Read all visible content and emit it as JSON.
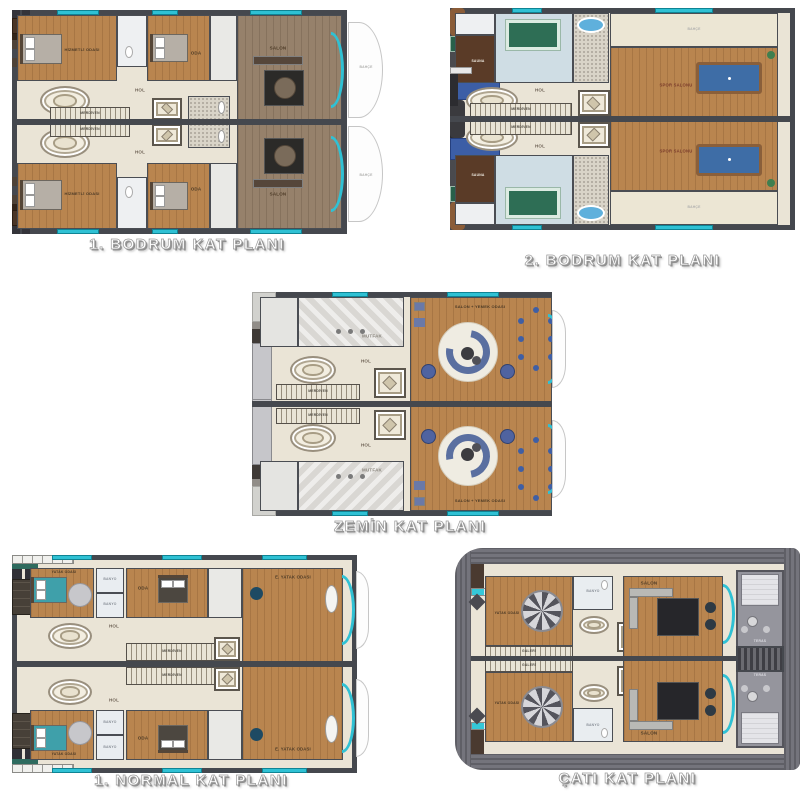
{
  "canvas": {
    "background": "#ffffff"
  },
  "colors": {
    "wall": "#45484e",
    "floor_cream": "#eae4d6",
    "wood": "#b9854f",
    "wood_taupe": "#96816b",
    "glass_teal": "#2fc1d4",
    "billiard_blue": "#3e6da6",
    "spa_green": "#2e6e55",
    "sauna_brown": "#5a3b27",
    "terrace_gray": "#95959d",
    "roof_gray": "#6a6a72",
    "sofa_blue": "#5a6fa0",
    "bed_teal": "#3fa0aa"
  },
  "plans": [
    {
      "title": "1. BODRUM KAT PLANI",
      "labels": {
        "service_room": "HİZMETLİ ODASI",
        "room": "ODA",
        "salon": "SALON",
        "hall": "HOL",
        "stairs": "MERDİVEN",
        "garden": "BAHÇE"
      }
    },
    {
      "title": "2. BODRUM KAT PLANI",
      "labels": {
        "sauna": "SAUNA",
        "gym": "SPOR SALONU",
        "hall": "HOL",
        "stairs": "MERDİVEN",
        "garden": "BAHÇE"
      }
    },
    {
      "title": "ZEMİN KAT PLANI",
      "labels": {
        "kitchen": "MUTFAK",
        "living": "SALON + YEMEK ODASI",
        "hall": "HOL",
        "stairs": "MERDİVEN"
      }
    },
    {
      "title": "1. NORMAL KAT PLANI",
      "labels": {
        "bedroom": "YATAK ODASI",
        "bath": "BANYO",
        "room": "ODA",
        "master": "E. YATAK ODASI",
        "hall": "HOL",
        "stairs": "MERDİVEN"
      }
    },
    {
      "title": "ÇATI KAT PLANI",
      "labels": {
        "bedroom": "YATAK ODASI",
        "bath": "BANYO",
        "salon": "SALON",
        "terrace": "TERAS",
        "gallery": "GALERİ"
      }
    }
  ]
}
